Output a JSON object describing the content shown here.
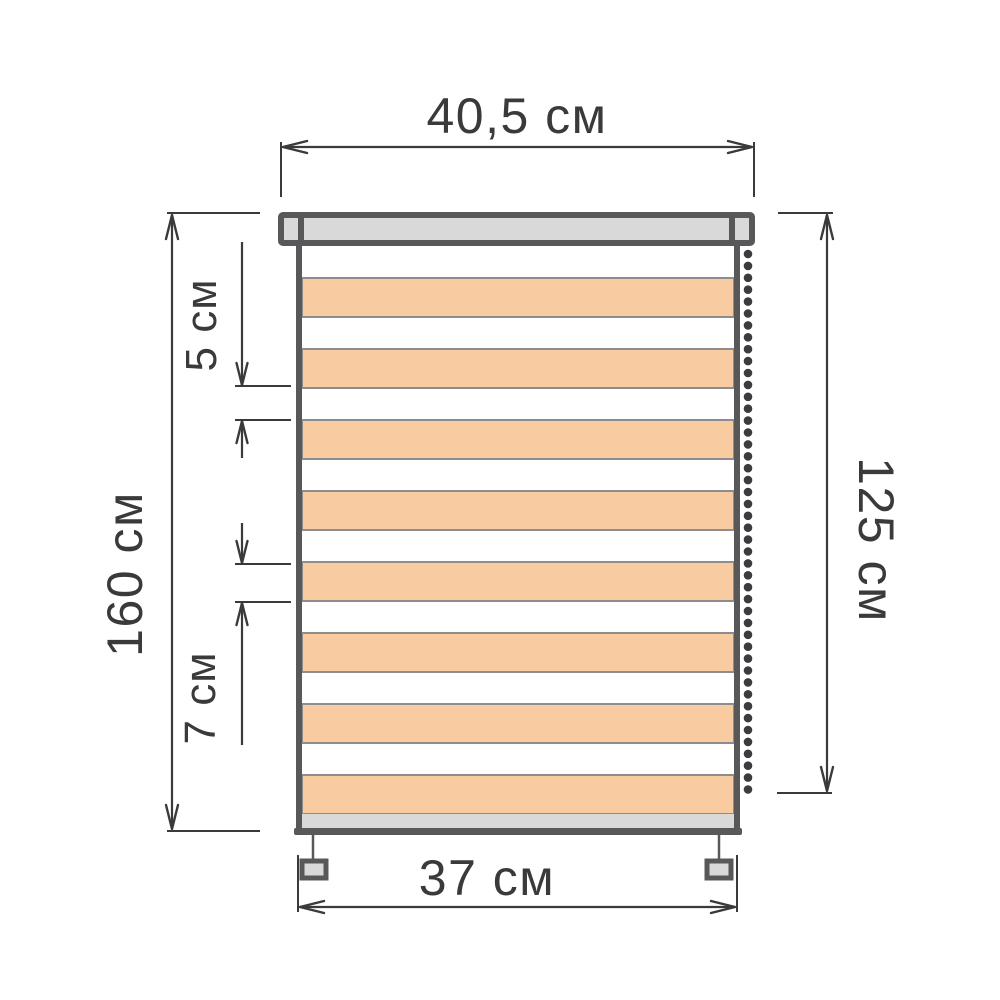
{
  "labels": {
    "top_width": "40,5 см",
    "left_height": "160 см",
    "right_height": "125 см",
    "white_stripe": "5 см",
    "orange_stripe": "7 см",
    "bottom_width": "37 см"
  },
  "colors": {
    "background": "#ffffff",
    "outline": "#58585a",
    "dimension": "#3a3a3c",
    "fill_light": "#d9d9d9",
    "fill_stripe": "#f8cba1",
    "stripe_edge": "#8d8d8f",
    "chain": "#3c3c3e",
    "fabric_white": "#ffffff"
  },
  "blind": {
    "stripe_pairs": 8,
    "stripe_area": {
      "x": 302,
      "width": 432,
      "top": 246,
      "white_height": 32,
      "orange_height": 39
    },
    "chain": {
      "cx": 748,
      "start_y": 254,
      "spacing": 11.9,
      "count": 46,
      "radius": 4.3
    }
  }
}
